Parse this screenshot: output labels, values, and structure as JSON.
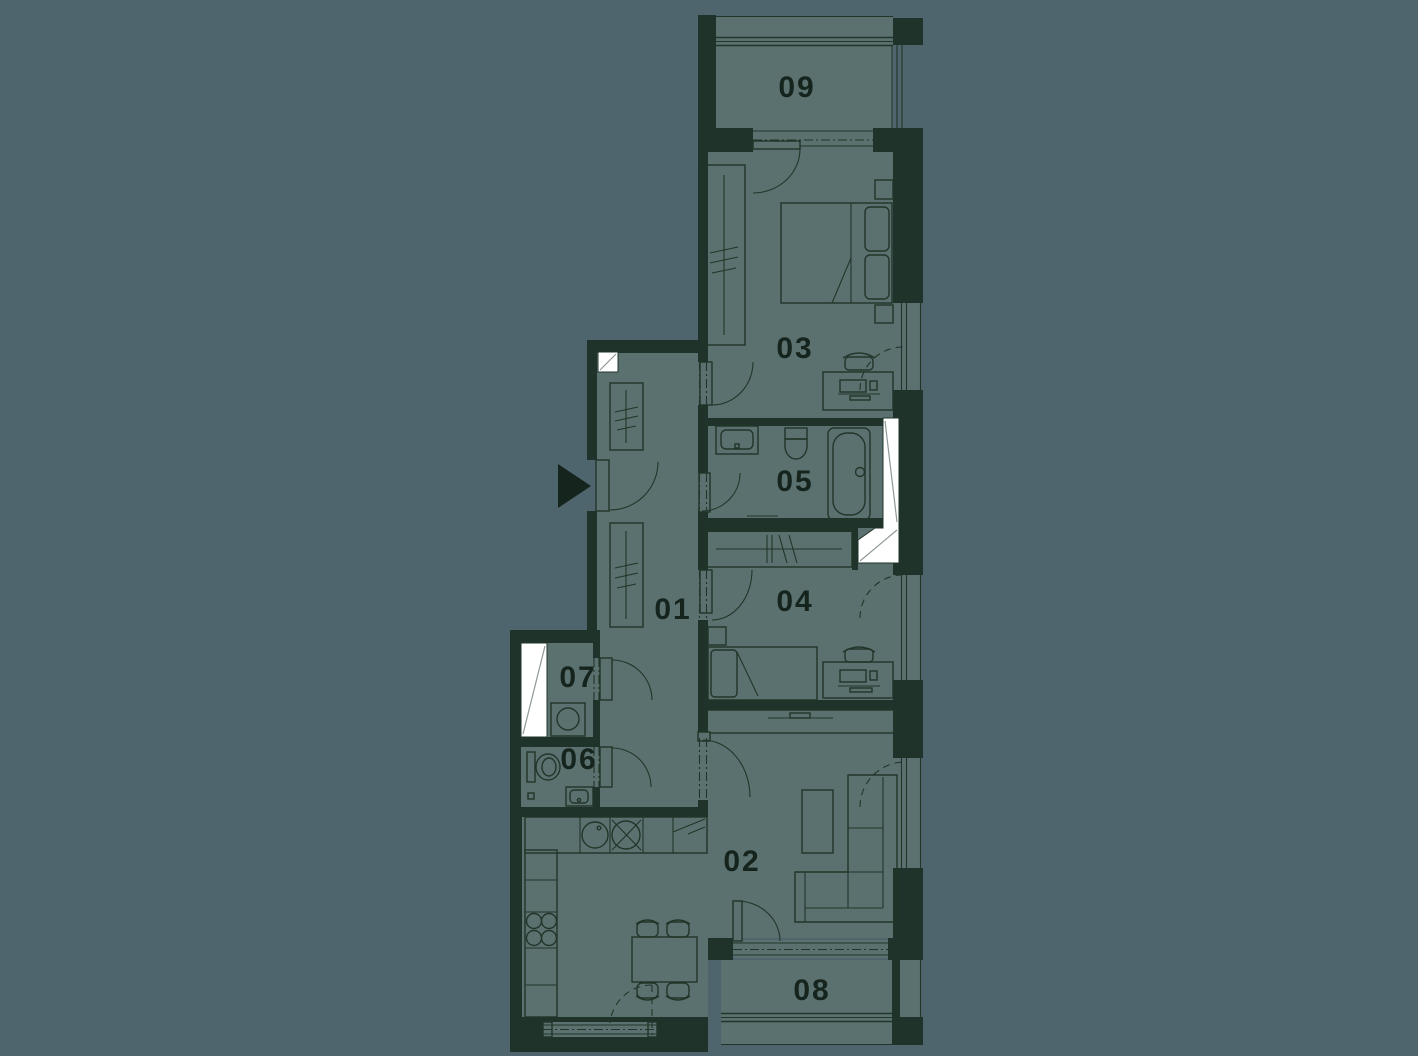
{
  "meta": {
    "title": "Apartment floor plan",
    "type": "architectural-floor-plan"
  },
  "palette": {
    "background": "#4e656d",
    "room": "#5a7170",
    "wall": "#20332a",
    "line": "#223528",
    "label": "#15241c",
    "shaft": "#ffffff",
    "shaft_line": "#8f9995"
  },
  "rooms": {
    "r01": {
      "label": "01"
    },
    "r02": {
      "label": "02"
    },
    "r03": {
      "label": "03"
    },
    "r04": {
      "label": "04"
    },
    "r05": {
      "label": "05"
    },
    "r06": {
      "label": "06"
    },
    "r07": {
      "label": "07"
    },
    "r08": {
      "label": "08"
    },
    "r09": {
      "label": "09"
    }
  },
  "icons": {
    "entrance": "entrance-arrow",
    "shaft": "void-diagonal-marker"
  }
}
